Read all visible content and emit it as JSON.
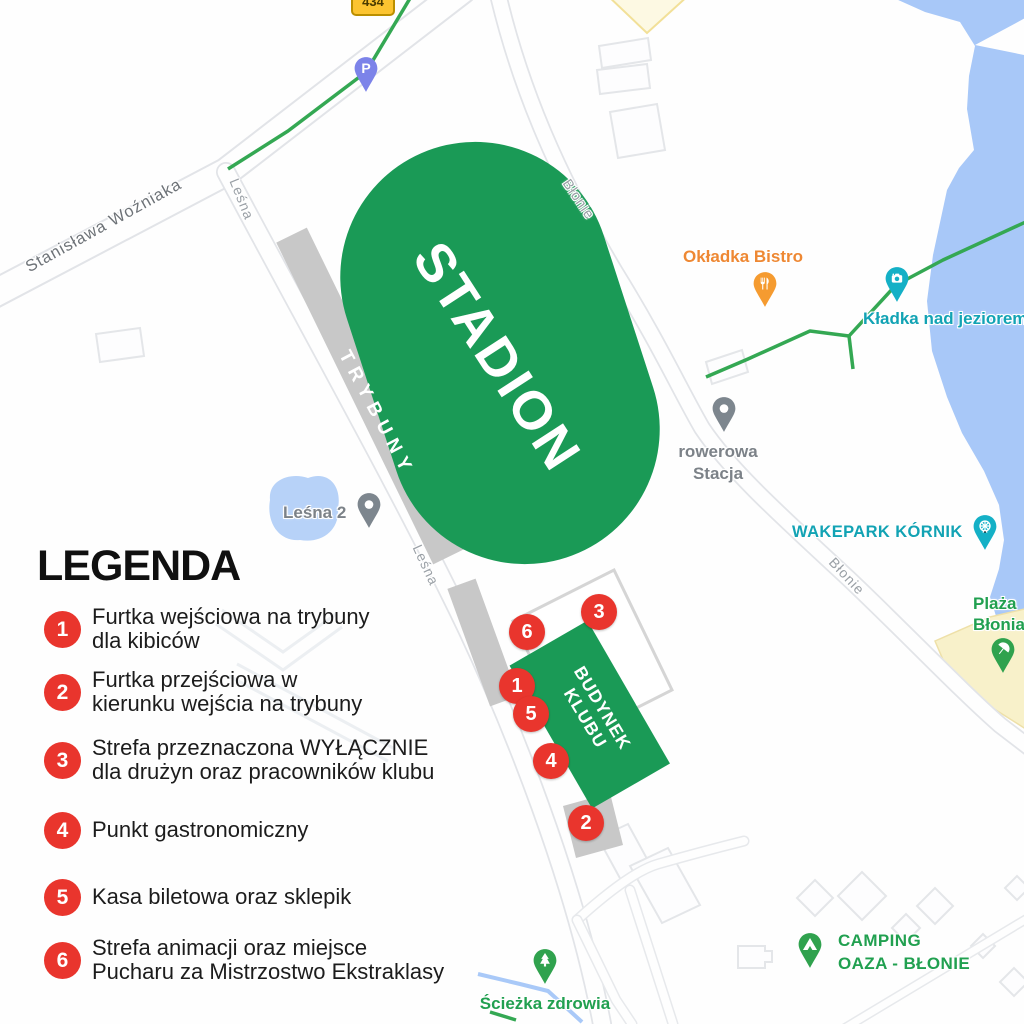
{
  "colors": {
    "stadium_green": "#1a9a56",
    "stands_gray": "#c8c8c8",
    "marker_red": "#e9352d",
    "water_blue": "#a8c8f8",
    "trail_green": "#34a853",
    "sand_yellow": "#f8f1ca",
    "poi_teal": "#12a3b4",
    "poi_orange": "#ee8833",
    "poi_green": "#21a050",
    "poi_gray": "#7c8288",
    "street_gray": "#9aa0a6"
  },
  "legend": {
    "title": "LEGENDA",
    "items": [
      {
        "number": "1",
        "lines": [
          "Furtka wejściowa na trybuny",
          "dla kibiców"
        ]
      },
      {
        "number": "2",
        "lines": [
          "Furtka przejściowa w",
          "kierunku wejścia na trybuny"
        ]
      },
      {
        "number": "3",
        "lines": [
          "Strefa przeznaczona WYŁĄCZNIE",
          "dla drużyn oraz pracowników klubu"
        ]
      },
      {
        "number": "4",
        "lines": [
          "Punkt gastronomiczny"
        ]
      },
      {
        "number": "5",
        "lines": [
          "Kasa biletowa oraz sklepik"
        ]
      },
      {
        "number": "6",
        "lines": [
          "Strefa animacji oraz miejsce",
          "Pucharu za Mistrzostwo Ekstraklasy"
        ]
      }
    ]
  },
  "map": {
    "route_badge": "434",
    "stadium_label": "STADION",
    "stands_label": "TRYBUNY",
    "club_building": {
      "lines": [
        "BUDYNEK",
        "KLUBU"
      ]
    },
    "markers": [
      {
        "number": "1"
      },
      {
        "number": "2"
      },
      {
        "number": "3"
      },
      {
        "number": "4"
      },
      {
        "number": "5"
      },
      {
        "number": "6"
      }
    ],
    "streets": {
      "wozniaka": "Stanisława Woźniaka",
      "lesna_top": "Leśna",
      "lesna_mid": "Leśna",
      "blonie_top": "Błonie",
      "blonie_right": "Błonie"
    },
    "pois": {
      "parking": {
        "icon_letter": "P"
      },
      "bistro": {
        "label": "Okładka Bistro"
      },
      "bridge": {
        "label": "Kładka nad jeziorem"
      },
      "bike_station": {
        "lines": [
          "rowerowa",
          "Stacja"
        ]
      },
      "lesna2": {
        "label": "Leśna 2"
      },
      "wakepark": {
        "label": "WAKEPARK KÓRNIK"
      },
      "beach": {
        "lines": [
          "Plaża",
          "Błonia"
        ]
      },
      "camping": {
        "lines": [
          "CAMPING",
          "OAZA - BŁONIE"
        ]
      },
      "health_path": {
        "label": "Ścieżka zdrowia"
      }
    }
  }
}
